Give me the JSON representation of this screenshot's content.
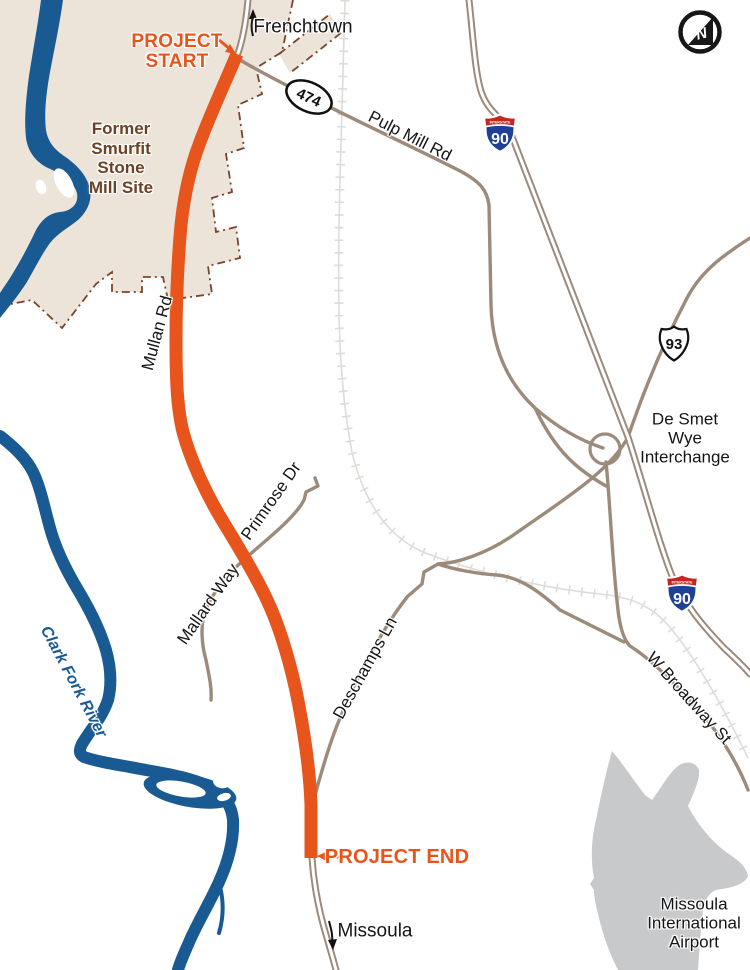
{
  "map": {
    "places": {
      "frenchtown": "Frenchtown",
      "missoula": "Missoula"
    },
    "markers": {
      "project_start": "PROJECT START",
      "project_end": "PROJECT END"
    },
    "roads": {
      "mullan_rd": "Mullan Rd",
      "pulp_mill_rd": "Pulp Mill Rd",
      "primrose_dr": "Primrose Dr",
      "mallard_way": "Mallard Way",
      "deschamps_ln": "Deschamps Ln",
      "w_broadway_st": "W Broadway St"
    },
    "areas": {
      "mill_site": "Former Smurfit Stone Mill Site",
      "airport": "Missoula International Airport",
      "interchange": "De Smet Wye Interchange"
    },
    "water": {
      "clark_fork_river": "Clark Fork River"
    },
    "shields": {
      "secondary_474": "474",
      "interstate_label": "INTERSTATE",
      "i90": "90",
      "us93": "93"
    },
    "north_indicator": "N",
    "colors": {
      "route_orange": "#E8551C",
      "river_blue": "#1A5A92",
      "road_tan": "#9C8B7B",
      "mill_site_beige": "#ECE4D9",
      "mill_boundary_brown": "#7B4427",
      "airport_gray": "#C8C9CB",
      "interstate_red": "#C5261F",
      "interstate_blue": "#1E4096",
      "railroad_gray": "#DCDCD8",
      "label_black": "#151515"
    }
  }
}
